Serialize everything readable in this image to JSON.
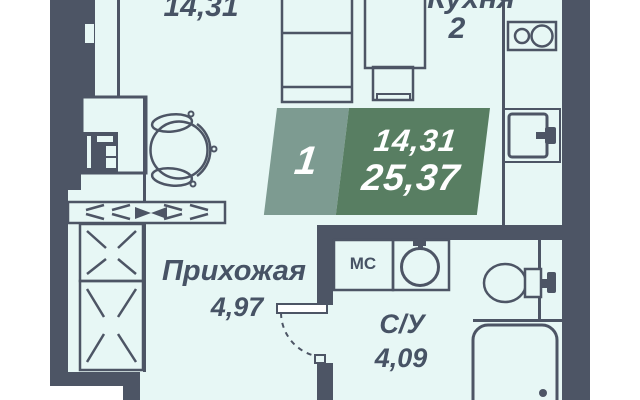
{
  "floorplan": {
    "rooms": {
      "living": {
        "area": "14,31"
      },
      "kitchen": {
        "name": "Кухня",
        "number": "2"
      },
      "hallway": {
        "name": "Прихожая",
        "area": "4,97"
      },
      "bathroom": {
        "name": "С/У",
        "area": "4,09"
      },
      "storage": {
        "name": "МС"
      }
    },
    "info_badge": {
      "rooms": "1",
      "living_area": "14,31",
      "total_area": "25,37"
    },
    "colors": {
      "wall": "#4d5565",
      "floor": "#e7f7f5",
      "outside": "#ffffff",
      "badge_left": "#7d9b91",
      "badge_right": "#587e62",
      "label_text": "#475365",
      "badge_text": "#ffffff"
    }
  }
}
